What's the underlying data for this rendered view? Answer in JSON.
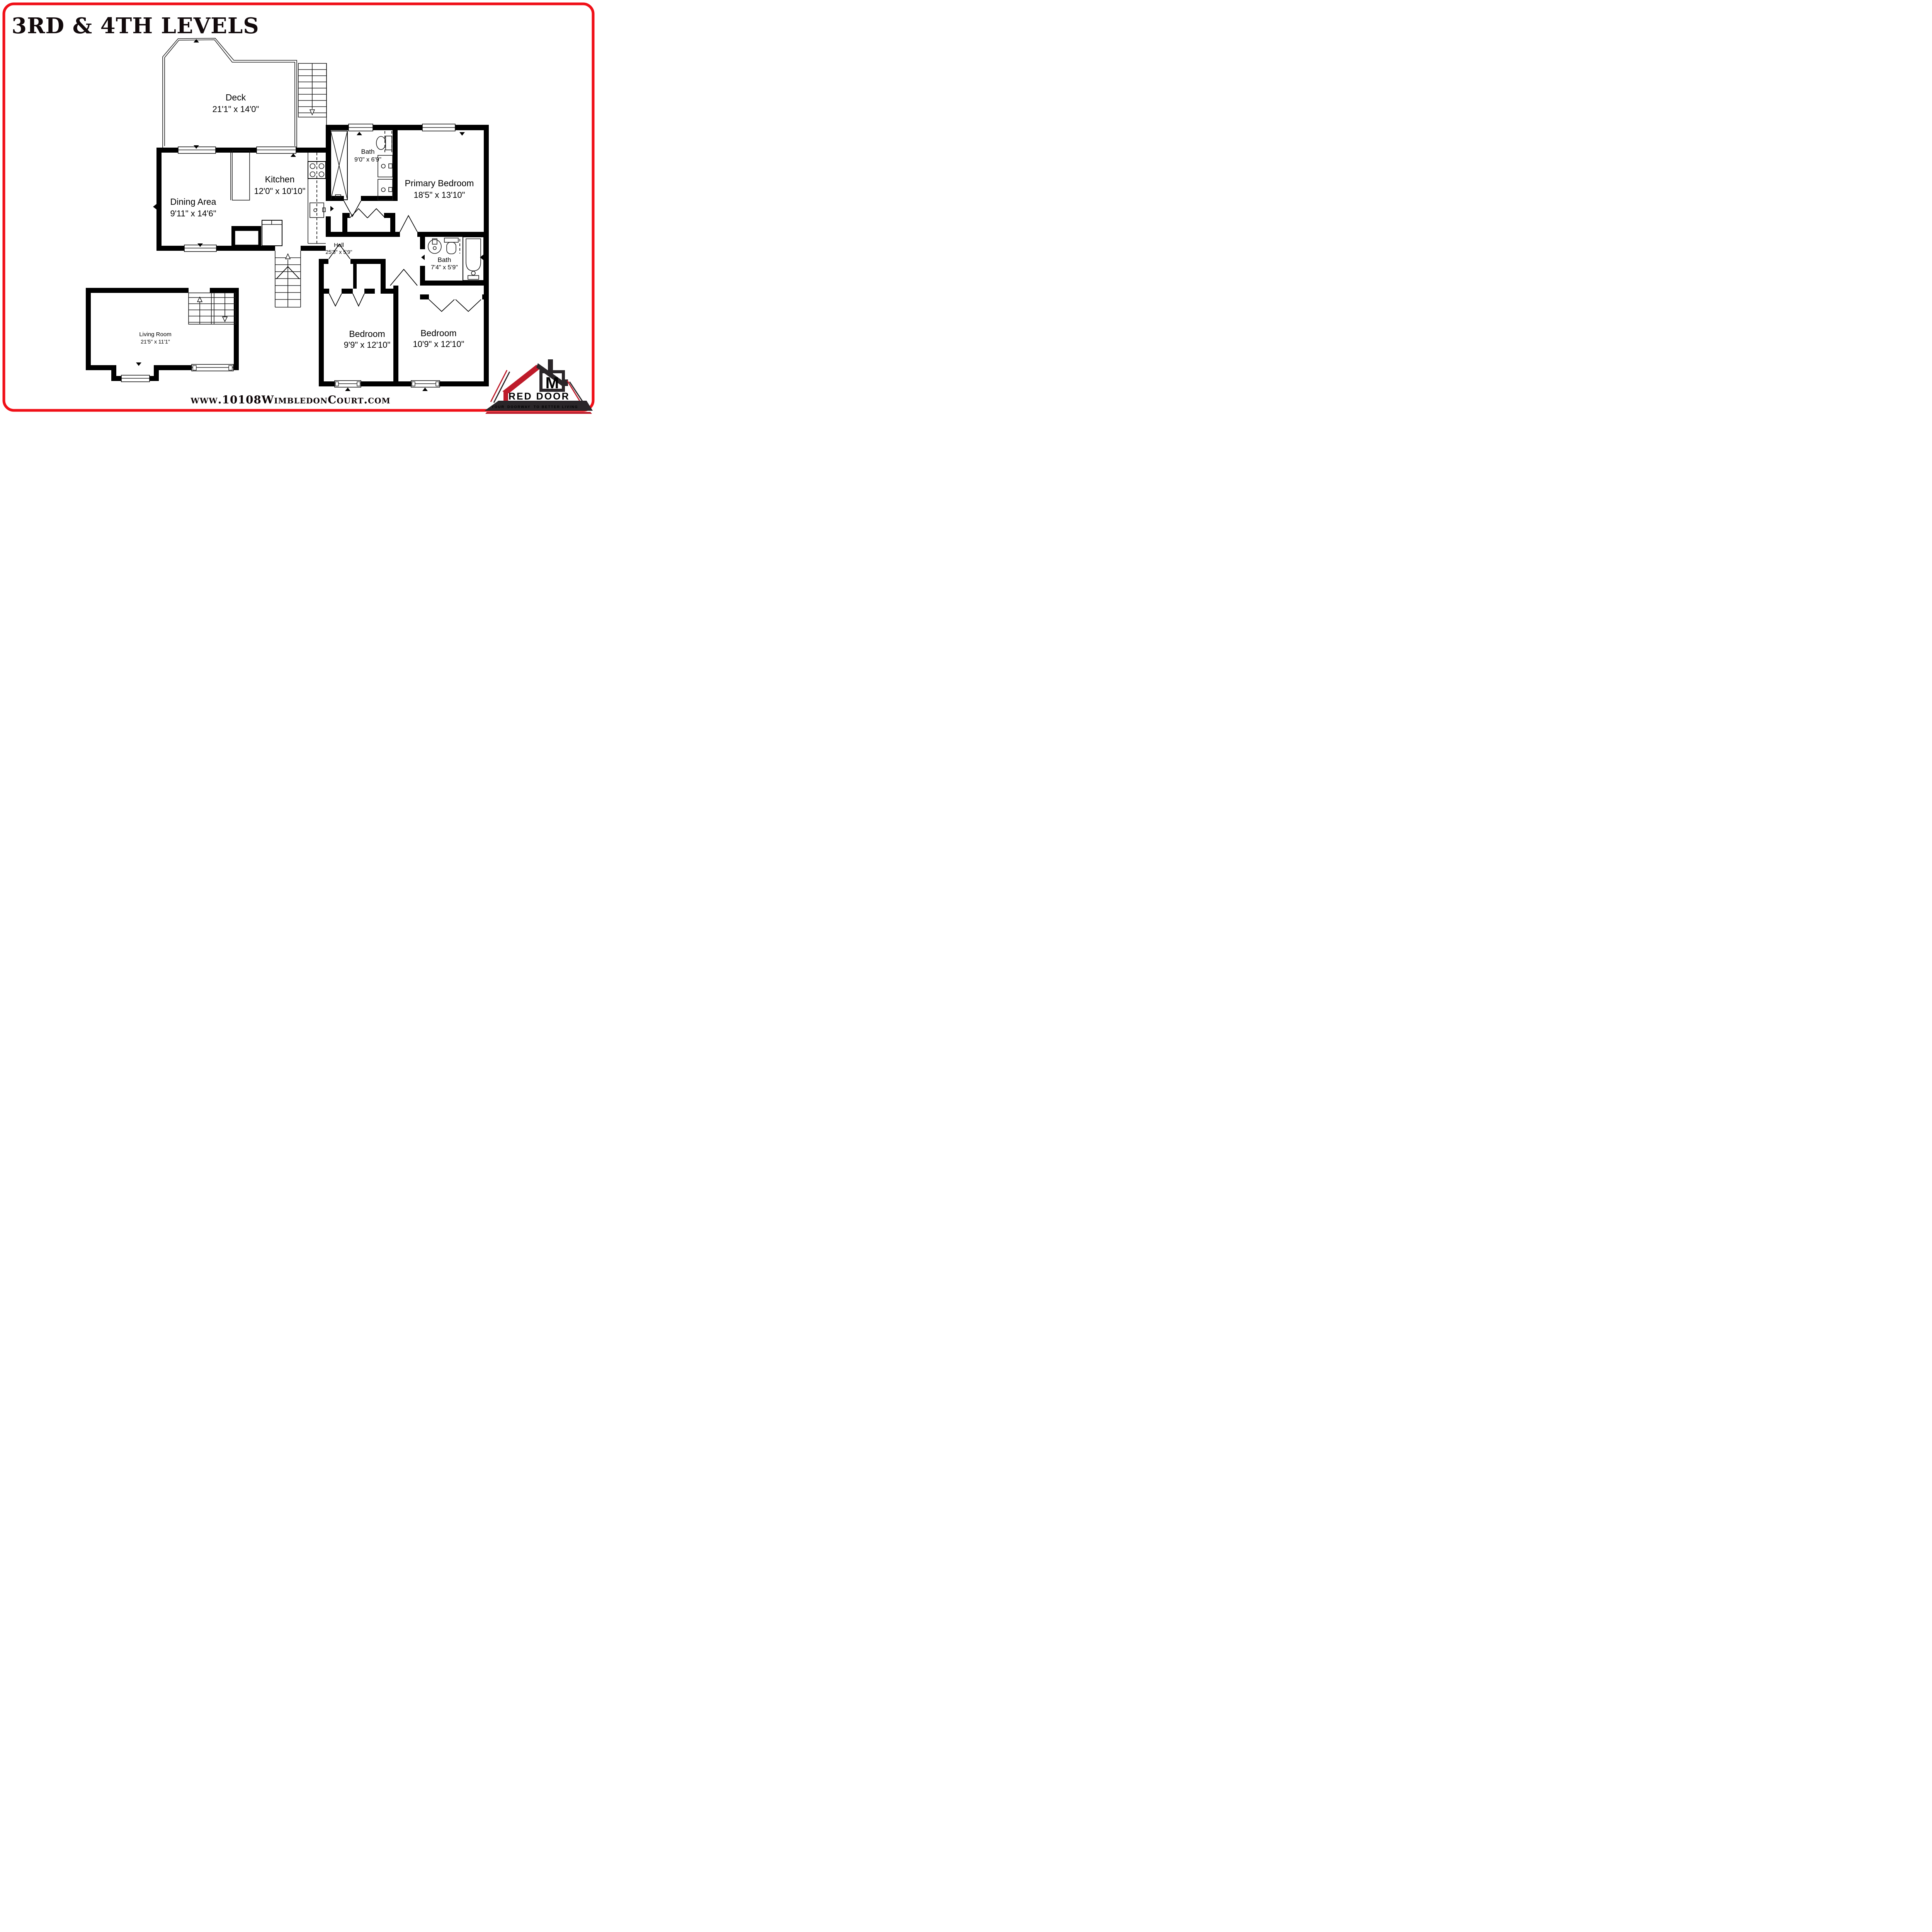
{
  "title": "3RD & 4TH LEVELS",
  "website": "www.10108WimbledonCourt.com",
  "rooms": [
    {
      "id": "deck",
      "name": "Deck",
      "dims": "21'1\" x 14'0\""
    },
    {
      "id": "kitchen",
      "name": "Kitchen",
      "dims": "12'0\" x 10'10\""
    },
    {
      "id": "dining-area",
      "name": "Dining Area",
      "dims": "9'11\" x 14'6\""
    },
    {
      "id": "bath-upper",
      "name": "Bath",
      "dims": "9'0\" x 6'9\""
    },
    {
      "id": "primary-bedroom",
      "name": "Primary Bedroom",
      "dims": "18'5\" x 13'10\""
    },
    {
      "id": "hall",
      "name": "Hall",
      "dims": "25'3\" x 5'9\""
    },
    {
      "id": "bath-lower",
      "name": "Bath",
      "dims": "7'4\" x 5'9\""
    },
    {
      "id": "bedroom-left",
      "name": "Bedroom",
      "dims": "9'9\" x 12'10\""
    },
    {
      "id": "bedroom-right",
      "name": "Bedroom",
      "dims": "10'9\" x 12'10\""
    },
    {
      "id": "living-room",
      "name": "Living Room",
      "dims": "21'5\" x 11'1\""
    }
  ],
  "logo": {
    "monogram": "M",
    "brand_initial": "R",
    "brand_rest": "ED DOOR",
    "brand_line2": "METRO",
    "tagline_1": "YOUR",
    "tagline_2": "DOORWAY",
    "tagline_3": "TO BETTER LIVING"
  },
  "colors": {
    "border_red": "#f01018",
    "logo_red": "#be1b2a",
    "logo_dark": "#2a2629",
    "wall_black": "#000000"
  }
}
